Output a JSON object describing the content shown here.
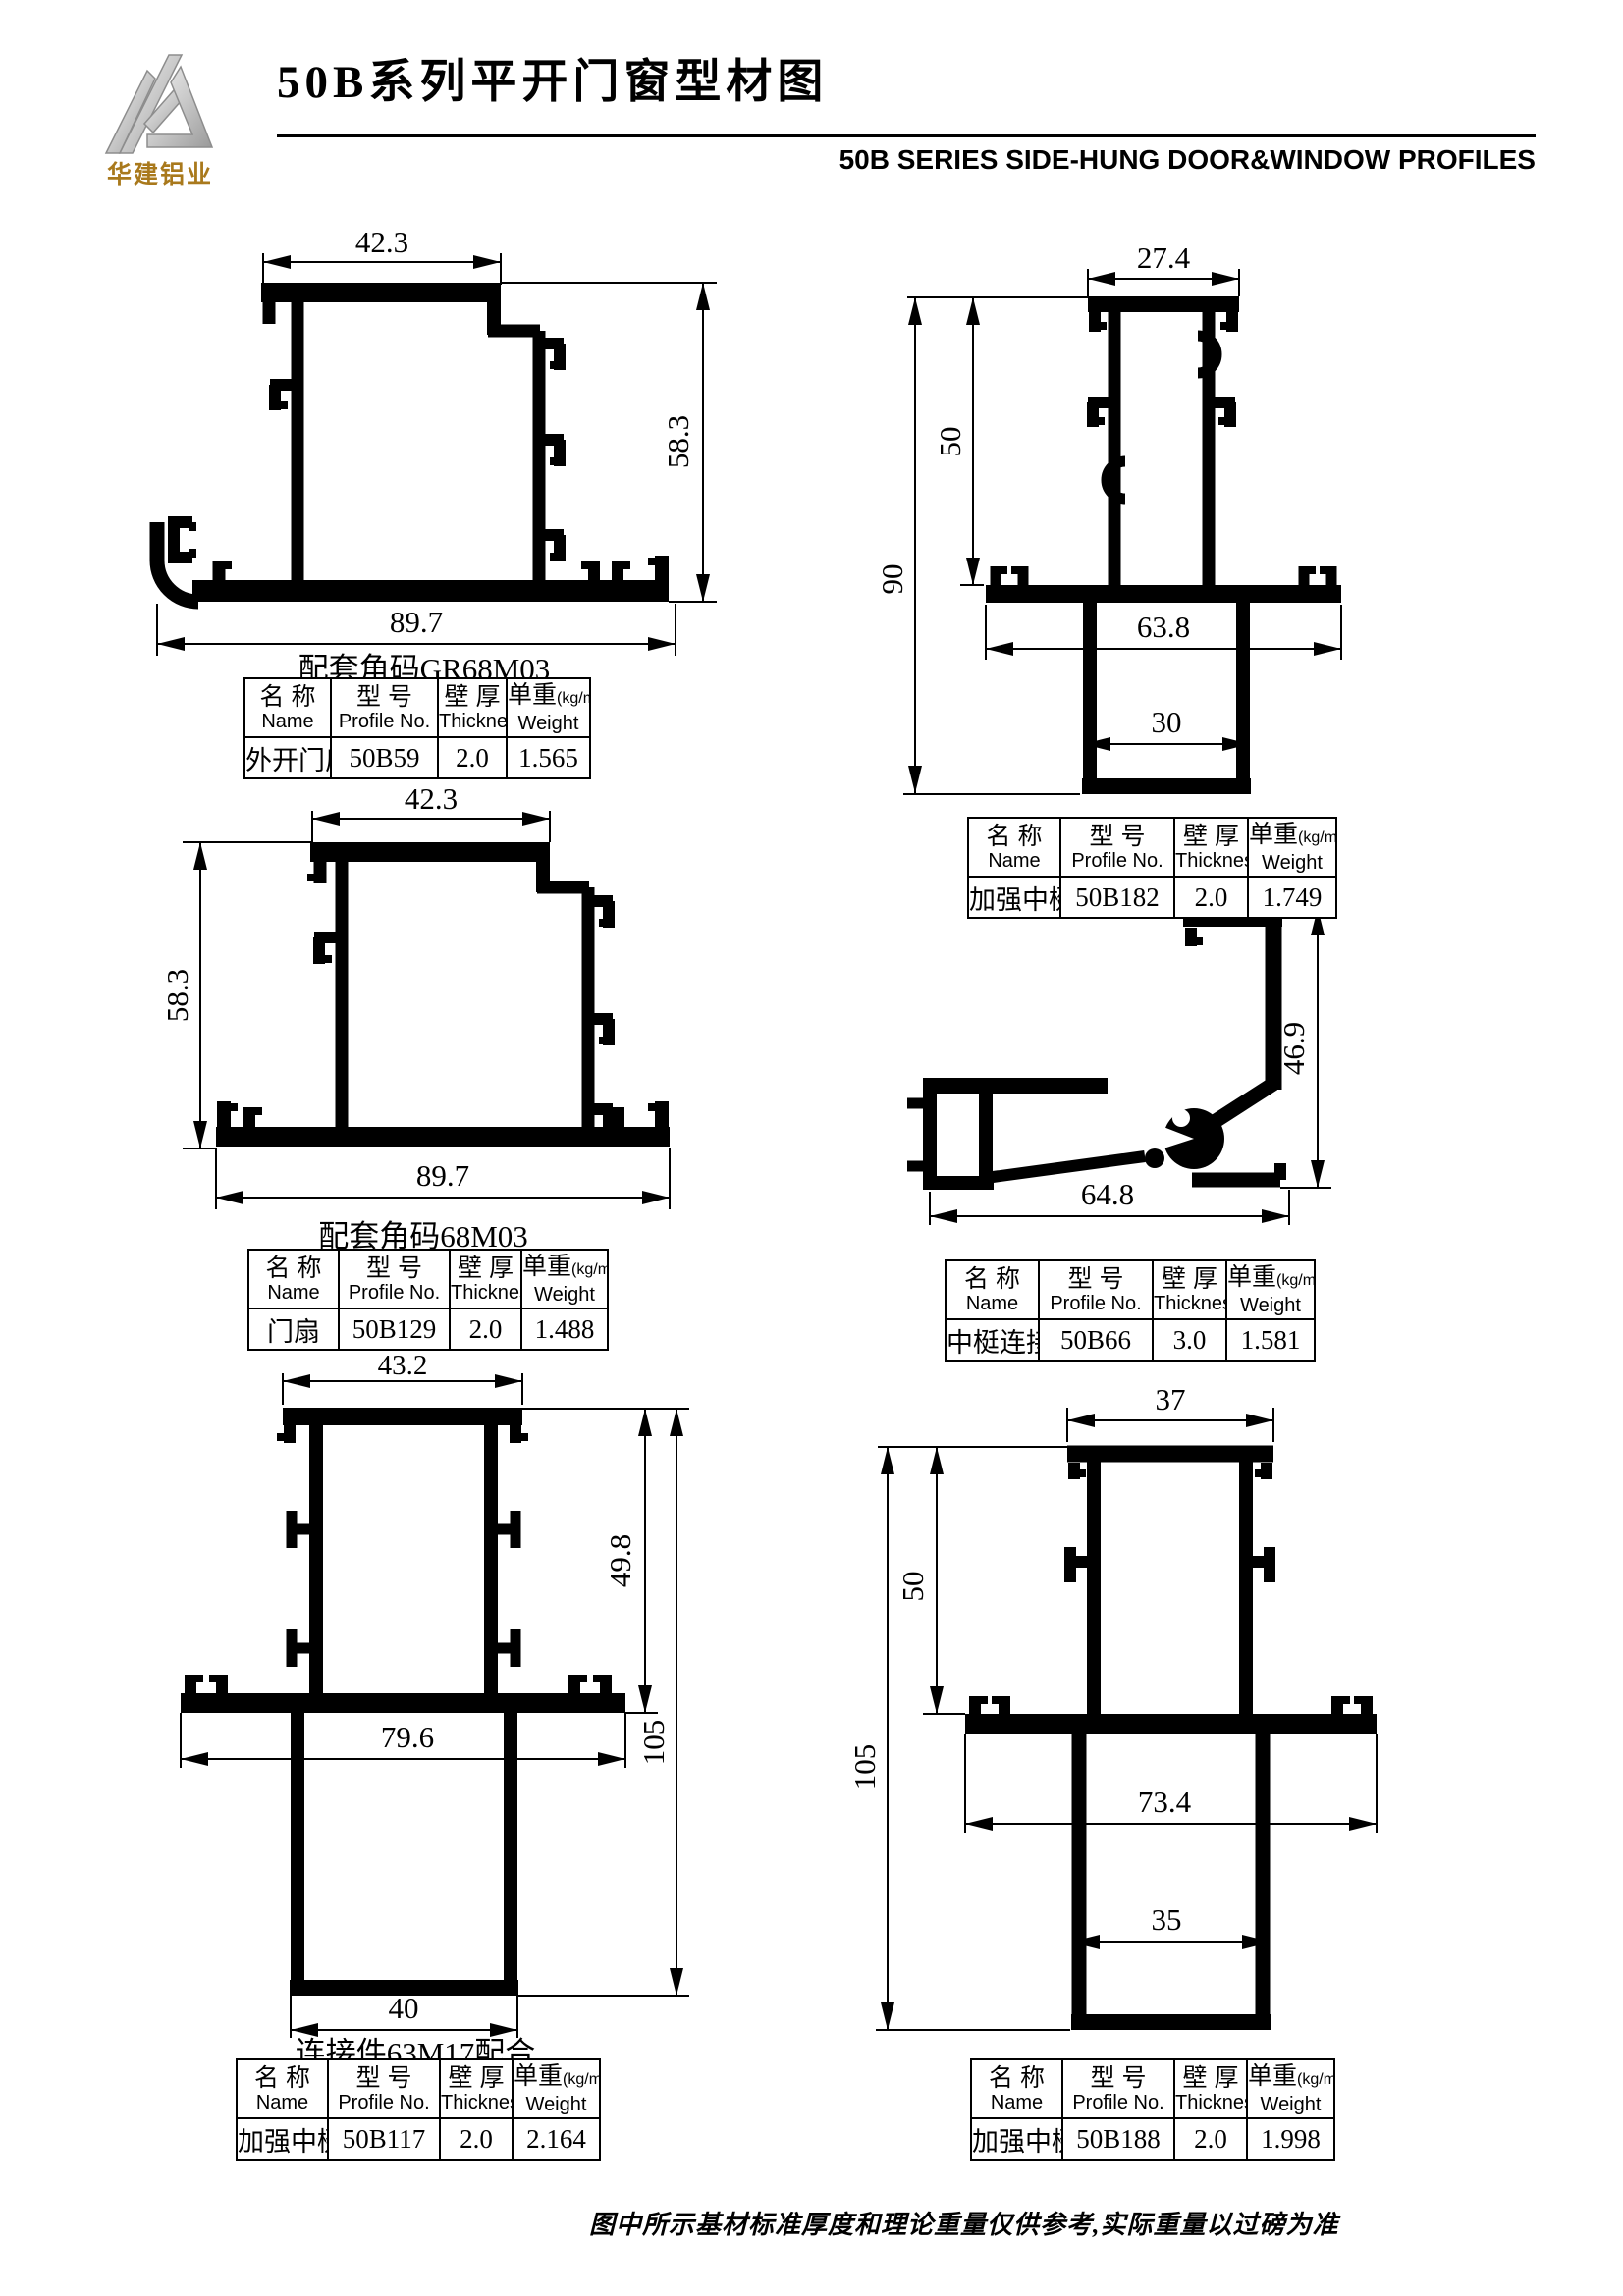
{
  "header": {
    "logo_text": "华建铝业",
    "title": "50B系列平开门窗型材图",
    "subtitle": "50B SERIES SIDE-HUNG DOOR&WINDOW PROFILES"
  },
  "table_headers": {
    "name_cn": "名 称",
    "name_en": "Name",
    "profile_cn": "型 号",
    "profile_en": "Profile No.",
    "thickness_cn": "壁 厚",
    "thickness_en": "Thickness",
    "weight_cn": "单重",
    "weight_unit": "(kg/m)",
    "weight_en": "Weight"
  },
  "profiles": [
    {
      "name": "外开门扇",
      "profile_no": "50B59",
      "thickness": "2.0",
      "weight": "1.565",
      "note": "配套角码GR68M03",
      "dims": {
        "top": "42.3",
        "side": "58.3",
        "bottom": "89.7"
      }
    },
    {
      "name": "加强中梃",
      "profile_no": "50B182",
      "thickness": "2.0",
      "weight": "1.749",
      "dims": {
        "top": "27.4",
        "inner": "50",
        "total": "90",
        "mid": "63.8",
        "lower": "30"
      }
    },
    {
      "name": "门扇",
      "profile_no": "50B129",
      "thickness": "2.0",
      "weight": "1.488",
      "note": "配套角码68M03",
      "dims": {
        "top": "42.3",
        "side": "58.3",
        "bottom": "89.7"
      }
    },
    {
      "name": "中梃连接件",
      "profile_no": "50B66",
      "thickness": "3.0",
      "weight": "1.581",
      "dims": {
        "side": "46.9",
        "bottom": "64.8"
      }
    },
    {
      "name": "加强中梃",
      "profile_no": "50B117",
      "thickness": "2.0",
      "weight": "2.164",
      "note": "连接件63M17配合",
      "dims": {
        "top": "43.2",
        "inner": "49.8",
        "total": "105",
        "mid": "79.6",
        "lower": "40"
      }
    },
    {
      "name": "加强中梃",
      "profile_no": "50B188",
      "thickness": "2.0",
      "weight": "1.998",
      "dims": {
        "top": "37",
        "inner": "50",
        "total": "105",
        "mid": "73.4",
        "lower": "35"
      }
    }
  ],
  "footer": {
    "note": "图中所示基材标准厚度和理论重量仅供参考,实际重量以过磅为准"
  }
}
